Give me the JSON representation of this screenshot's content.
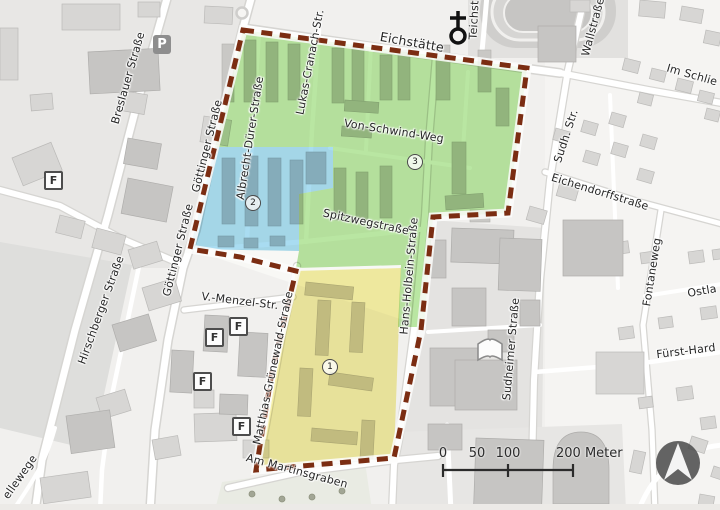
{
  "streets": [
    "Eichstätte",
    "Teichst",
    "Wallstraße",
    "Im Schlie",
    "Sudh. Str.",
    "Eichendorffstraße",
    "Fontaneweg",
    "Ostla",
    "Fürst-Hard",
    "Sudheimer Straße",
    "Hans-Holbein-Straße",
    "Breslauer Straße",
    "Göttinger Straße",
    "Göttinger Straße",
    "Hirschberger Straße",
    "Albrecht-Dürer-Straße",
    "Lukas-Cranach-Str.",
    "Von-Schwind-Weg",
    "Spitzwegstraße",
    "Matthias-Grünewald-Straße",
    "V.-Menzel-Str.",
    "Am Martinsgraben",
    "ellewege"
  ],
  "zone_markers": [
    "1",
    "2",
    "3"
  ],
  "map_icons": {
    "parking": "P",
    "f_box": "F"
  },
  "scale_bar": {
    "labels": [
      "0",
      "50",
      "100",
      "200 Meter"
    ]
  },
  "zones": {
    "green": "#b9e6a2",
    "blue": "#a9dcf1",
    "yellow": "#f5efa5",
    "boundary": "#7b2d12"
  }
}
